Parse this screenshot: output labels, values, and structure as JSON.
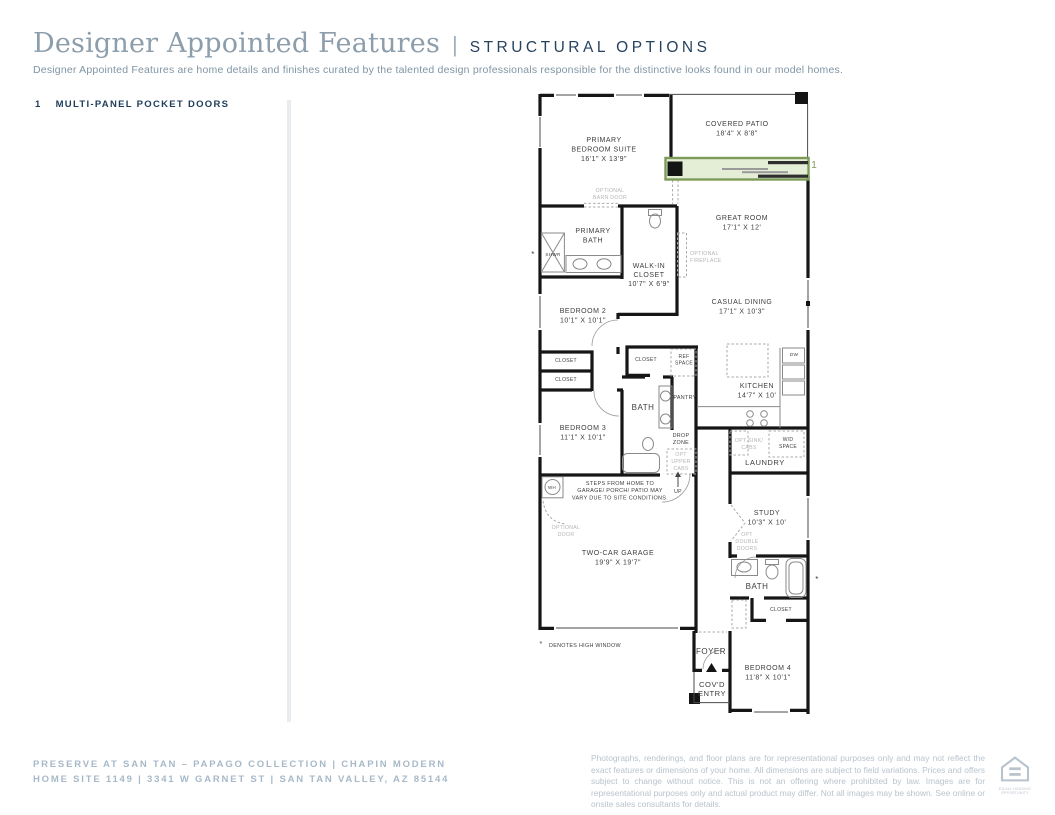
{
  "header": {
    "title": "Designer Appointed Features",
    "pipe": "|",
    "subtitle_label": "STRUCTURAL OPTIONS",
    "description": "Designer Appointed Features are home details and finishes curated by the talented design professionals responsible for the distinctive looks found in our model homes."
  },
  "features": [
    {
      "number": "1",
      "label": "MULTI-PANEL POCKET DOORS"
    }
  ],
  "footer": {
    "community_line": "PRESERVE AT SAN TAN – PAPAGO COLLECTION   |   CHAPIN MODERN",
    "address_line": "HOME SITE 1149   |   3341 W GARNET ST   |   SAN TAN VALLEY, AZ 85144",
    "disclaimer": "Photographs, renderings, and floor plans are for representational purposes only and may not reflect the exact features or dimensions of your home. All dimensions are subject to field variations. Prices and offers subject to change without notice. This is not an offering where prohibited by law. Images are for representational purposes only and actual product may differ. Not all images may be shown. See online or onsite sales consultants for details.",
    "logo_caption_line1": "EQUAL HOUSING",
    "logo_caption_line2": "OPPORTUNITY"
  },
  "floor_plan": {
    "highlight_color": "#7d9b58",
    "highlight_fill": "#e4edd6",
    "labels": [
      {
        "id": "primary-bedroom-suite-label",
        "x": 604,
        "y": 142,
        "lh": 9.5,
        "style": "room",
        "lines": [
          "PRIMARY",
          "BEDROOM SUITE",
          "16'1\" X 13'9\""
        ]
      },
      {
        "id": "covered-patio-label",
        "x": 737,
        "y": 126,
        "lh": 9.5,
        "style": "room",
        "lines": [
          "COVERED PATIO",
          "18'4\" X 8'8\""
        ]
      },
      {
        "id": "great-room-label",
        "x": 742,
        "y": 220,
        "lh": 9.5,
        "style": "room",
        "lines": [
          "GREAT ROOM",
          "17'1\" X 12'"
        ]
      },
      {
        "id": "optional-barn-door-label",
        "x": 610,
        "y": 192,
        "lh": 7,
        "style": "opt",
        "lines": [
          "OPTIONAL",
          "BARN DOOR"
        ]
      },
      {
        "id": "primary-bath-label",
        "x": 593,
        "y": 233,
        "lh": 9.5,
        "style": "room",
        "lines": [
          "PRIMARY",
          "BATH"
        ]
      },
      {
        "id": "shower-label",
        "x": 553,
        "y": 256,
        "size": 4.6,
        "style": "tiny",
        "lines": [
          "SHWR"
        ]
      },
      {
        "id": "optional-fireplace-label",
        "x": 690,
        "y": 255,
        "lh": 7,
        "style": "opt",
        "anchor": "start",
        "lines": [
          "OPTIONAL",
          "FIREPLACE"
        ]
      },
      {
        "id": "walk-in-closet-label",
        "x": 649,
        "y": 268,
        "lh": 9,
        "style": "room",
        "lines": [
          "WALK-IN",
          "CLOSET",
          "10'7\" X 6'9\""
        ]
      },
      {
        "id": "bedroom-2-label",
        "x": 583,
        "y": 313,
        "lh": 9.5,
        "style": "room",
        "lines": [
          "BEDROOM 2",
          "10'1\" X 10'1\""
        ]
      },
      {
        "id": "casual-dining-label",
        "x": 742,
        "y": 304,
        "lh": 9.5,
        "style": "room",
        "lines": [
          "CASUAL DINING",
          "17'1\" X 10'3\""
        ]
      },
      {
        "id": "bedroom2-closet-upper-label",
        "x": 566,
        "y": 362,
        "style": "tiny",
        "lines": [
          "CLOSET"
        ]
      },
      {
        "id": "bedroom2-closet-lower-label",
        "x": 566,
        "y": 381,
        "style": "tiny",
        "lines": [
          "CLOSET"
        ]
      },
      {
        "id": "hall-closet-label",
        "x": 646,
        "y": 361,
        "style": "tiny",
        "lines": [
          "CLOSET"
        ]
      },
      {
        "id": "ref-space-label",
        "x": 684,
        "y": 358,
        "lh": 6.5,
        "style": "tiny",
        "lines": [
          "REF",
          "SPACE"
        ]
      },
      {
        "id": "hall-bath-label",
        "x": 643,
        "y": 410,
        "size": 8,
        "style": "room",
        "lines": [
          "BATH"
        ]
      },
      {
        "id": "pantry-label",
        "x": 685,
        "y": 399,
        "size": 5.4,
        "style": "tiny",
        "lines": [
          "PANTRY"
        ]
      },
      {
        "id": "kitchen-label",
        "x": 757,
        "y": 388,
        "lh": 9.5,
        "style": "room",
        "lines": [
          "KITCHEN",
          "14'7\" X 10'"
        ]
      },
      {
        "id": "dishwasher-label",
        "x": 794,
        "y": 356,
        "size": 4.8,
        "style": "tiny",
        "lines": [
          "DW"
        ]
      },
      {
        "id": "bedroom-3-label",
        "x": 583,
        "y": 430,
        "lh": 9.5,
        "style": "room",
        "lines": [
          "BEDROOM 3",
          "11'1\" X 10'1\""
        ]
      },
      {
        "id": "drop-zone-label",
        "x": 681,
        "y": 437,
        "lh": 7,
        "size": 5.4,
        "style": "tiny",
        "lines": [
          "DROP",
          "ZONE"
        ]
      },
      {
        "id": "opt-sink-cabs-label",
        "x": 749,
        "y": 442,
        "lh": 7,
        "style": "opt",
        "lines": [
          "OPT SINK/",
          "CABS"
        ]
      },
      {
        "id": "wd-space-label",
        "x": 788,
        "y": 441,
        "lh": 7,
        "style": "tiny",
        "lines": [
          "W/D",
          "SPACE"
        ]
      },
      {
        "id": "laundry-label",
        "x": 765,
        "y": 465,
        "size": 7.6,
        "style": "room",
        "lines": [
          "LAUNDRY"
        ]
      },
      {
        "id": "opt-upper-cabs-label",
        "x": 681,
        "y": 456,
        "lh": 7,
        "style": "opt",
        "lines": [
          "OPT",
          "UPPER",
          "CABS"
        ]
      },
      {
        "id": "up-label",
        "x": 678,
        "y": 493,
        "size": 5.2,
        "style": "tiny",
        "lines": [
          "UP"
        ]
      },
      {
        "id": "water-heater-label",
        "x": 552,
        "y": 489,
        "size": 4.4,
        "style": "tiny",
        "lines": [
          "WH"
        ]
      },
      {
        "id": "steps-note-label",
        "x": 620,
        "y": 485,
        "lh": 7.2,
        "style": "note",
        "lines": [
          "STEPS FROM HOME TO",
          "GARAGE/ PORCH/ PATIO MAY",
          "VARY DUE TO SITE CONDITIONS."
        ]
      },
      {
        "id": "optional-door-label",
        "x": 566,
        "y": 529,
        "lh": 7,
        "style": "opt",
        "lines": [
          "OPTIONAL",
          "DOOR"
        ]
      },
      {
        "id": "study-label",
        "x": 767,
        "y": 515,
        "lh": 9.5,
        "style": "room",
        "lines": [
          "STUDY",
          "10'3\" X 10'"
        ]
      },
      {
        "id": "opt-double-doors-label",
        "x": 747,
        "y": 536,
        "lh": 7,
        "style": "opt",
        "lines": [
          "OPT",
          "DOUBLE",
          "DOORS"
        ]
      },
      {
        "id": "two-car-garage-label",
        "x": 618,
        "y": 555,
        "lh": 9.5,
        "style": "room",
        "lines": [
          "TWO-CAR GARAGE",
          "19'9\" X 19'7\""
        ]
      },
      {
        "id": "study-bath-label",
        "x": 757,
        "y": 589,
        "size": 8,
        "style": "room",
        "lines": [
          "BATH"
        ]
      },
      {
        "id": "bedroom4-closet-label",
        "x": 781,
        "y": 611,
        "style": "tiny",
        "lines": [
          "CLOSET"
        ]
      },
      {
        "id": "foyer-label",
        "x": 711,
        "y": 654,
        "size": 8,
        "style": "room",
        "lines": [
          "FOYER"
        ]
      },
      {
        "id": "bedroom-4-label",
        "x": 768,
        "y": 670,
        "lh": 9.5,
        "style": "room",
        "lines": [
          "BEDROOM 4",
          "11'8\" X 10'1\""
        ]
      },
      {
        "id": "covd-entry-label",
        "x": 712,
        "y": 687,
        "lh": 9,
        "size": 7.6,
        "style": "room",
        "lines": [
          "COV'D",
          "ENTRY"
        ]
      },
      {
        "id": "high-window-asterisk-shower",
        "x": 533,
        "y": 257,
        "size": 8,
        "style": "note",
        "lines": [
          "*"
        ]
      },
      {
        "id": "high-window-asterisk-bath",
        "x": 817,
        "y": 582,
        "size": 8,
        "style": "note",
        "lines": [
          "*"
        ]
      },
      {
        "id": "denotes-asterisk",
        "x": 541,
        "y": 646,
        "size": 7,
        "style": "note",
        "lines": [
          "*"
        ]
      },
      {
        "id": "denotes-high-window-label",
        "x": 549,
        "y": 647,
        "size": 5.4,
        "style": "note",
        "anchor": "start",
        "lines": [
          "DENOTES HIGH WINDOW"
        ]
      },
      {
        "id": "pocket-door-callout",
        "x": 814,
        "y": 168,
        "style": "green",
        "lines": [
          "1"
        ]
      }
    ]
  }
}
